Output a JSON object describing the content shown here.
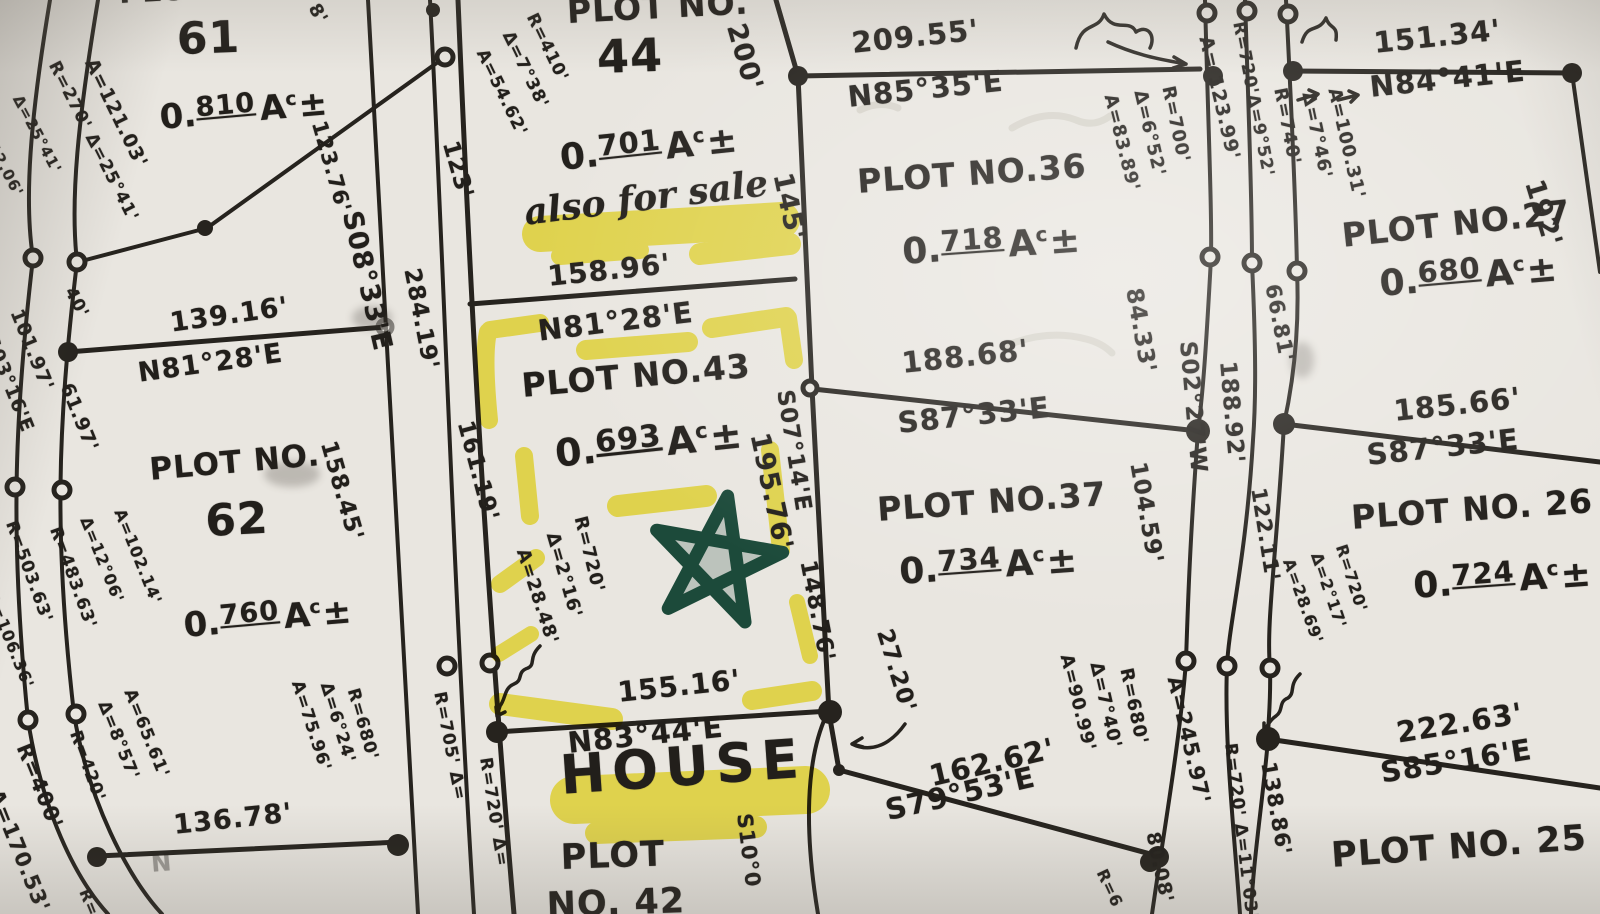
{
  "plots": {
    "p61": {
      "line1": "PLOT NO.",
      "line2": "61",
      "acre": {
        "pre": "0.",
        "num": "810",
        "a": "A",
        "c": "c",
        "pm": "±"
      }
    },
    "p62": {
      "line1": "PLOT NO.",
      "line2": "62",
      "acre": {
        "pre": "0.",
        "num": "760",
        "a": "A",
        "c": "c",
        "pm": "±"
      }
    },
    "p44": {
      "line1": "PLOT NO.",
      "line2": "44",
      "acre": {
        "pre": "0.",
        "num": "701",
        "a": "A",
        "c": "c",
        "pm": "±"
      }
    },
    "p43": {
      "title": "PLOT NO.43",
      "acre": {
        "pre": "0.",
        "num": "693",
        "a": "A",
        "c": "c",
        "pm": "±"
      }
    },
    "p36": {
      "title": "PLOT NO.36",
      "acre": {
        "pre": "0.",
        "num": "718",
        "a": "A",
        "c": "c",
        "pm": "±"
      }
    },
    "p37": {
      "title": "PLOT NO.37",
      "acre": {
        "pre": "0.",
        "num": "734",
        "a": "A",
        "c": "c",
        "pm": "±"
      }
    },
    "p27": {
      "title": "PLOT NO.27",
      "acre": {
        "pre": "0.",
        "num": "680",
        "a": "A",
        "c": "c",
        "pm": "±"
      }
    },
    "p26": {
      "title": "PLOT NO. 26",
      "acre": {
        "pre": "0.",
        "num": "724",
        "a": "A",
        "c": "c",
        "pm": "±"
      }
    },
    "p42": {
      "line1": "PLOT",
      "line2": "NO. 42"
    },
    "p25": {
      "title": "PLOT NO. 25"
    }
  },
  "annotations": {
    "also_for_sale": "also for sale",
    "house": "HOUSE"
  },
  "bearings": {
    "b81_28a": "N81°28'E",
    "b81_28b": "N81°28'E",
    "b85_35": "N85°35'E",
    "b84_41": "N84°41'E",
    "b87_33a": "S87°33'E",
    "b87_33b": "S87°33'E",
    "b83_44": "N83°44'E",
    "b79_53": "S79°53'E",
    "b85_16": "S85°16'E",
    "road_s08_33": "S08°33'E",
    "road_s03_16": "S03°16'E",
    "road_s02_27": "S02°27'W",
    "road_s07_14": "S07°14'E",
    "road_s10": "S10°0"
  },
  "distances": {
    "d139_16": "139.16'",
    "d101_97": "101.97'",
    "d61_97": "61.97'",
    "d40": "40'",
    "d12_06": "12.06'",
    "d136_78": "136.78'",
    "d123_76": "123.76'",
    "d123": "123'",
    "d284_19": "284.19'",
    "d158_45": "158.45'",
    "d161_19": "161.19'",
    "d158_96": "158.96'",
    "d200": "200'",
    "d145": "145'",
    "d209_55": "209.55'",
    "d151_34": "151.34'",
    "d192": "192'",
    "d195_76": "195.76'",
    "d148_76": "148.76'",
    "d188_68": "188.68'",
    "d84_33": "84.33'",
    "d104_59": "104.59'",
    "d66_81": "66.81'",
    "d122_11": "122.11'",
    "d188_92": "188.92'",
    "d185_66": "185.66'",
    "d155_16": "155.16'",
    "d27_20": "27.20'",
    "d162_62": "162.62'",
    "d222_63": "222.63'",
    "d138_86": "138.86'",
    "d80_08": "80.08'",
    "d123_99": "A= 123.99'",
    "frag_8": "8'",
    "frag_n": "N",
    "frag_r": "R=",
    "frag_r6": "R=6"
  },
  "curves": {
    "c61_a": "A=121.03'",
    "c61_r": "R=270' Δ=25°41'",
    "c61_d2": "Δ=25°41'",
    "c62_r483": "R=483.63'",
    "c62_r503": "R=503.63'",
    "c62_d12": "Δ=12°06'",
    "c62_a102": "A=102.14'",
    "c62_a106": "A=106.36'",
    "c62_r400": "R=400'",
    "c62_a170": "A=170.53'",
    "c62_r420": "R=420'",
    "c62_d8": "Δ=8°57'",
    "c62_a65": "A=65.61'",
    "c62_r680": "R=680'",
    "c62_d6": "Δ=6°24'",
    "c62_a75": "A=75.96'",
    "c44_r": "R=410'",
    "c44_d": "Δ=7°38'",
    "c44_a": "A=54.62'",
    "c43_r": "R=720'",
    "c43_d": "Δ=2°16'",
    "c43_a": "A=28.48'",
    "c36_r": "R=700'",
    "c36_d": "Δ=6°52'",
    "c36_a": "A=83.89'",
    "c37_r": "R=680'",
    "c37_d": "Δ=7°40'",
    "c37_a": "A=90.99'",
    "c26_r": "R=720'",
    "c26_d": "Δ=2°17'",
    "c26_a": "A=28.69'",
    "road_r720_9": "R=720'Δ=9°52'",
    "road_r740": "R=740'",
    "road_d7_46": "Δ=7°46'",
    "road_a100": "A=100.31'",
    "road_a245": "A=245.97'",
    "road_r705": "R=705' Δ=",
    "road_r720cut": "R=720' Δ=",
    "road_r720_11": "R=720' Δ=11°03'"
  },
  "colors": {
    "ink": "#26231e",
    "highlighter": "#f2e327",
    "marker_green": "#1c4a3a",
    "paper": "#e9e6e0"
  }
}
